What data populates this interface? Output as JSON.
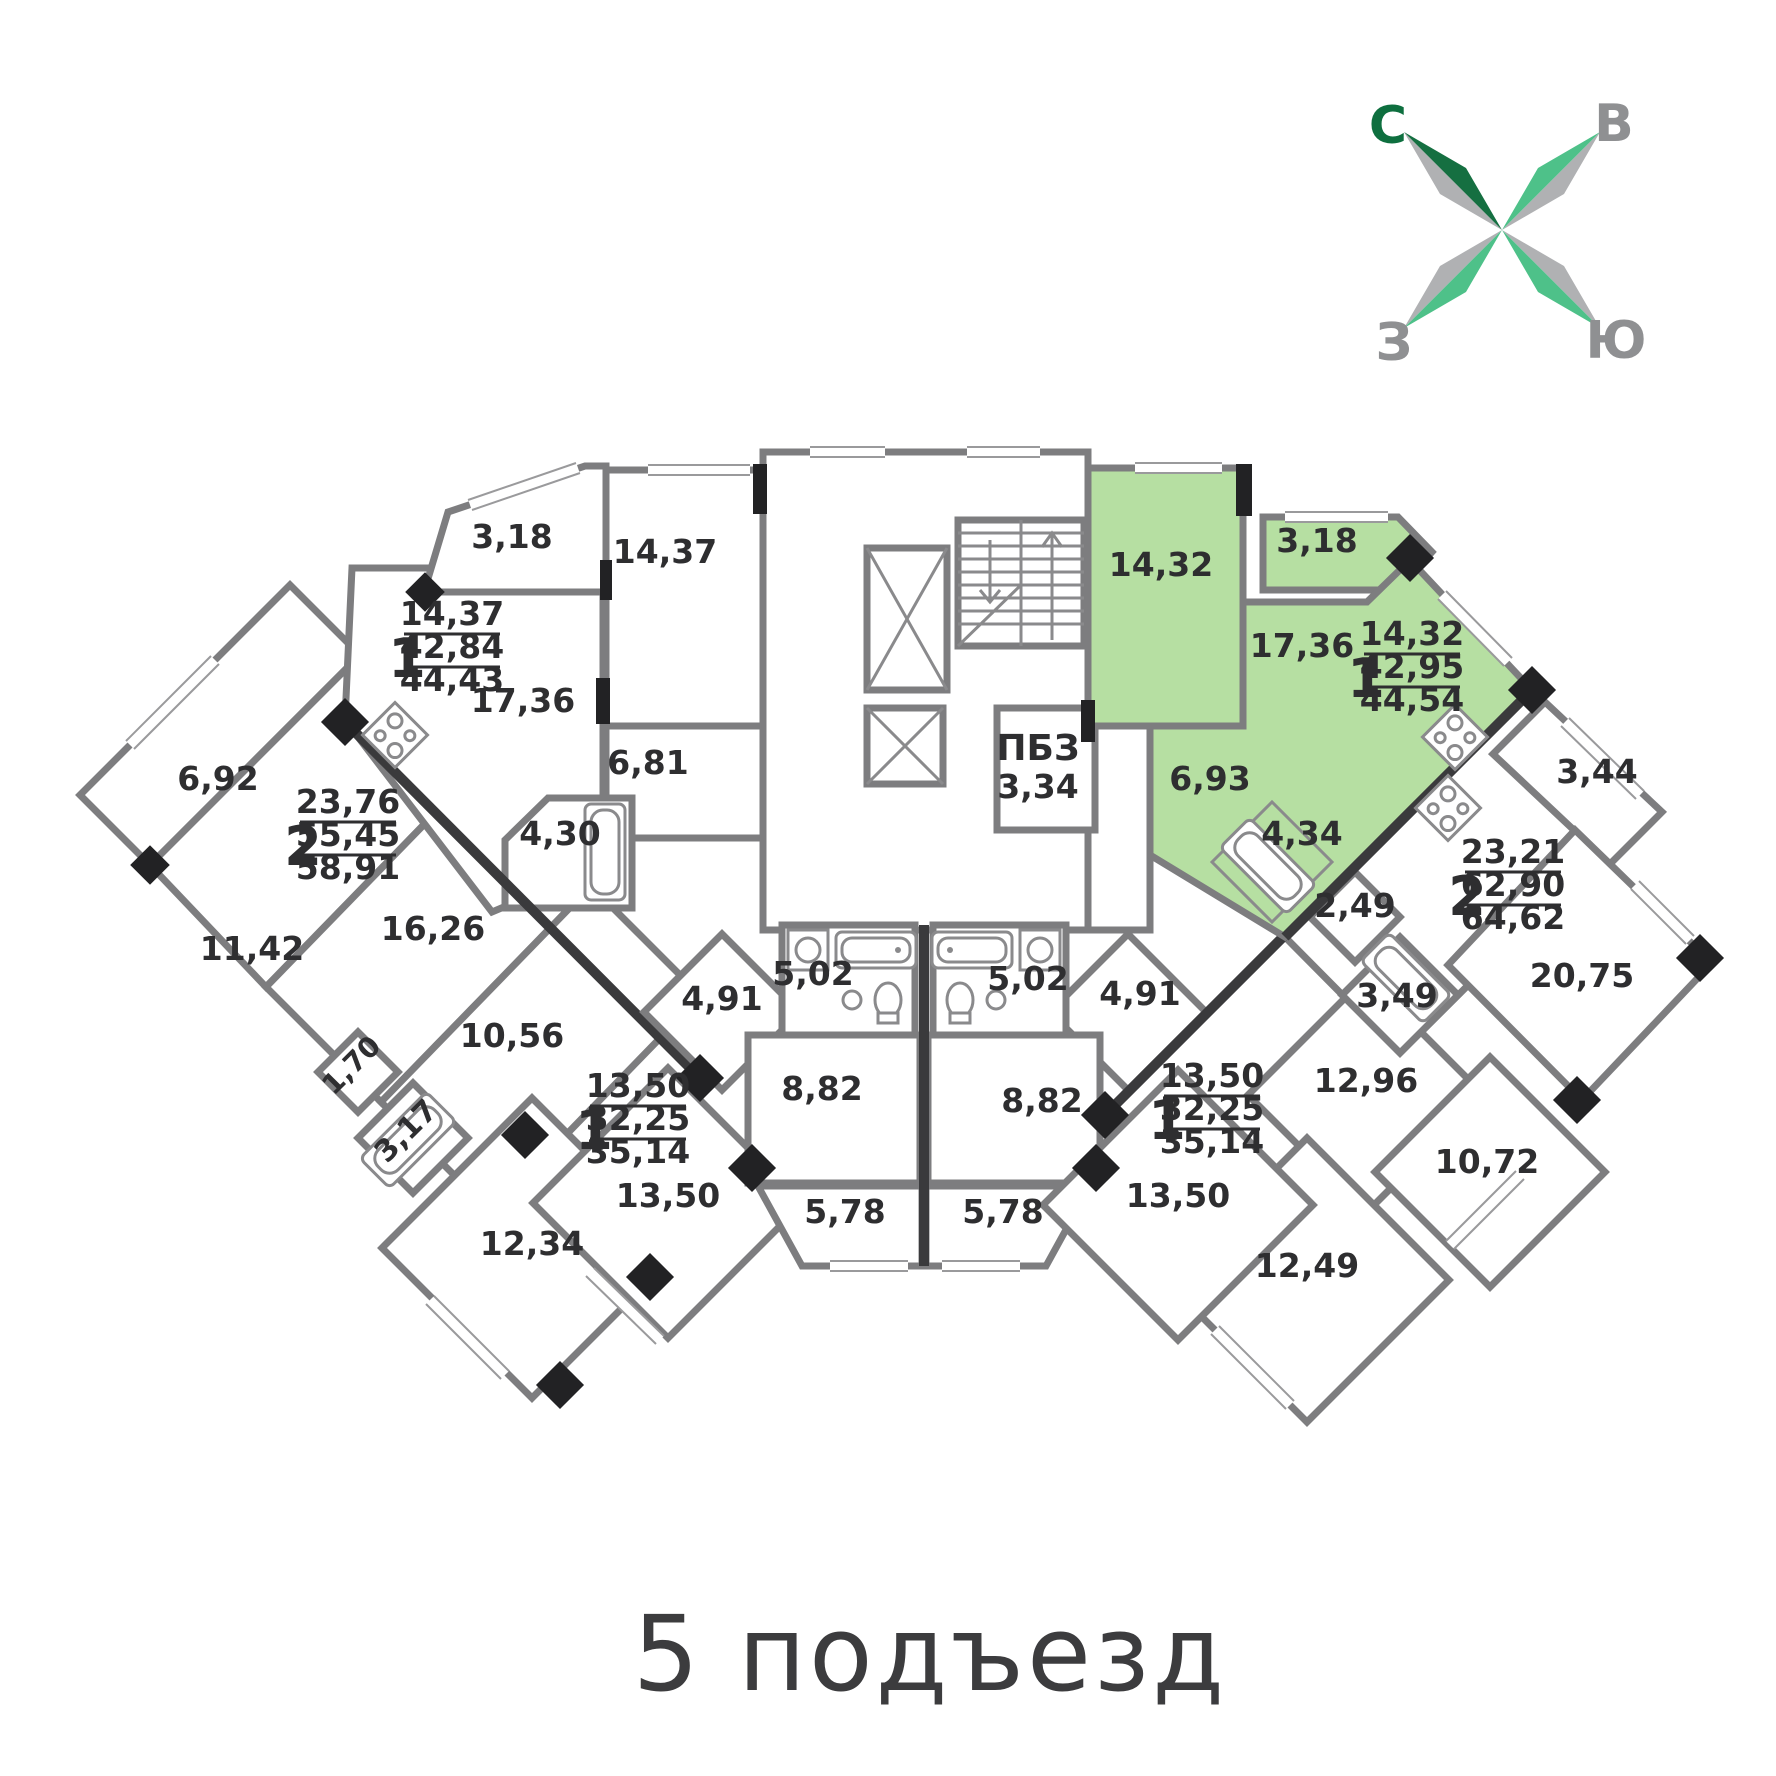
{
  "title": "5 подъезд",
  "compass": {
    "north": "С",
    "east": "В",
    "west": "З",
    "south": "Ю",
    "north_color": "#0e6f3f",
    "letter_gray": "#8f9092",
    "arm_dark_green": "#156f41",
    "arm_light_green": "#4ec189",
    "arm_gray": "#b0b1b3"
  },
  "colors": {
    "highlight_green": "#b6dfa2",
    "wall_gray": "#7d7d7f",
    "wall_dark": "#3a3a3c",
    "text": "#2e2e30"
  },
  "core": {
    "stairwell": "stairs",
    "elevators": 2
  },
  "rooms": [
    {
      "t": "3,18",
      "x": 512,
      "y": 548
    },
    {
      "t": "14,37",
      "x": 665,
      "y": 563
    },
    {
      "t": "17,36",
      "x": 523,
      "y": 712
    },
    {
      "t": "6,81",
      "x": 648,
      "y": 774
    },
    {
      "t": "4,30",
      "x": 560,
      "y": 845
    },
    {
      "t": "6,92",
      "x": 218,
      "y": 790
    },
    {
      "t": "11,42",
      "x": 252,
      "y": 960
    },
    {
      "t": "16,26",
      "x": 433,
      "y": 940
    },
    {
      "t": "10,56",
      "x": 512,
      "y": 1047
    },
    {
      "t": "1,70",
      "x": 358,
      "y": 1072,
      "r": -45,
      "s": 28
    },
    {
      "t": "3,17",
      "x": 413,
      "y": 1138,
      "r": -45,
      "s": 30
    },
    {
      "t": "12,34",
      "x": 532,
      "y": 1255
    },
    {
      "t": "13,50",
      "x": 668,
      "y": 1207
    },
    {
      "t": "4,91",
      "x": 722,
      "y": 1010
    },
    {
      "t": "5,02",
      "x": 813,
      "y": 985
    },
    {
      "t": "8,82",
      "x": 822,
      "y": 1100
    },
    {
      "t": "5,78",
      "x": 845,
      "y": 1223
    },
    {
      "t": "5,78",
      "x": 1003,
      "y": 1223
    },
    {
      "t": "8,82",
      "x": 1042,
      "y": 1112
    },
    {
      "t": "5,02",
      "x": 1028,
      "y": 990
    },
    {
      "t": "4,91",
      "x": 1140,
      "y": 1005
    },
    {
      "t": "13,50",
      "x": 1178,
      "y": 1207
    },
    {
      "t": "14,32",
      "x": 1161,
      "y": 576
    },
    {
      "t": "3,18",
      "x": 1317,
      "y": 552
    },
    {
      "t": "17,36",
      "x": 1302,
      "y": 657
    },
    {
      "t": "6,93",
      "x": 1210,
      "y": 790
    },
    {
      "t": "4,34",
      "x": 1302,
      "y": 845
    },
    {
      "t": "2,49",
      "x": 1355,
      "y": 917
    },
    {
      "t": "3,49",
      "x": 1397,
      "y": 1007
    },
    {
      "t": "3,44",
      "x": 1597,
      "y": 783
    },
    {
      "t": "20,75",
      "x": 1582,
      "y": 987
    },
    {
      "t": "12,96",
      "x": 1366,
      "y": 1092
    },
    {
      "t": "10,72",
      "x": 1487,
      "y": 1173
    },
    {
      "t": "12,49",
      "x": 1307,
      "y": 1277
    },
    {
      "t": "ПБЗ",
      "x": 1038,
      "y": 760,
      "s": 36
    },
    {
      "t": "3,34",
      "x": 1038,
      "y": 798,
      "s": 33
    }
  ],
  "apartments": [
    {
      "num": "1",
      "values": [
        "14,37",
        "42,84",
        "44,43"
      ],
      "nx": 407,
      "sx": 452,
      "ty": 625
    },
    {
      "num": "2",
      "values": [
        "23,76",
        "55,45",
        "58,91"
      ],
      "nx": 303,
      "sx": 348,
      "ty": 813
    },
    {
      "num": "1",
      "values": [
        "14,32",
        "42,95",
        "44,54"
      ],
      "nx": 1366,
      "sx": 1412,
      "ty": 645
    },
    {
      "num": "2",
      "values": [
        "23,21",
        "62,90",
        "64,62"
      ],
      "nx": 1467,
      "sx": 1513,
      "ty": 863
    },
    {
      "num": "1",
      "values": [
        "13,50",
        "32,25",
        "35,14"
      ],
      "nx": 594,
      "sx": 638,
      "ty": 1097
    },
    {
      "num": "1",
      "values": [
        "13,50",
        "32,25",
        "35,14"
      ],
      "nx": 1167,
      "sx": 1212,
      "ty": 1087
    }
  ]
}
